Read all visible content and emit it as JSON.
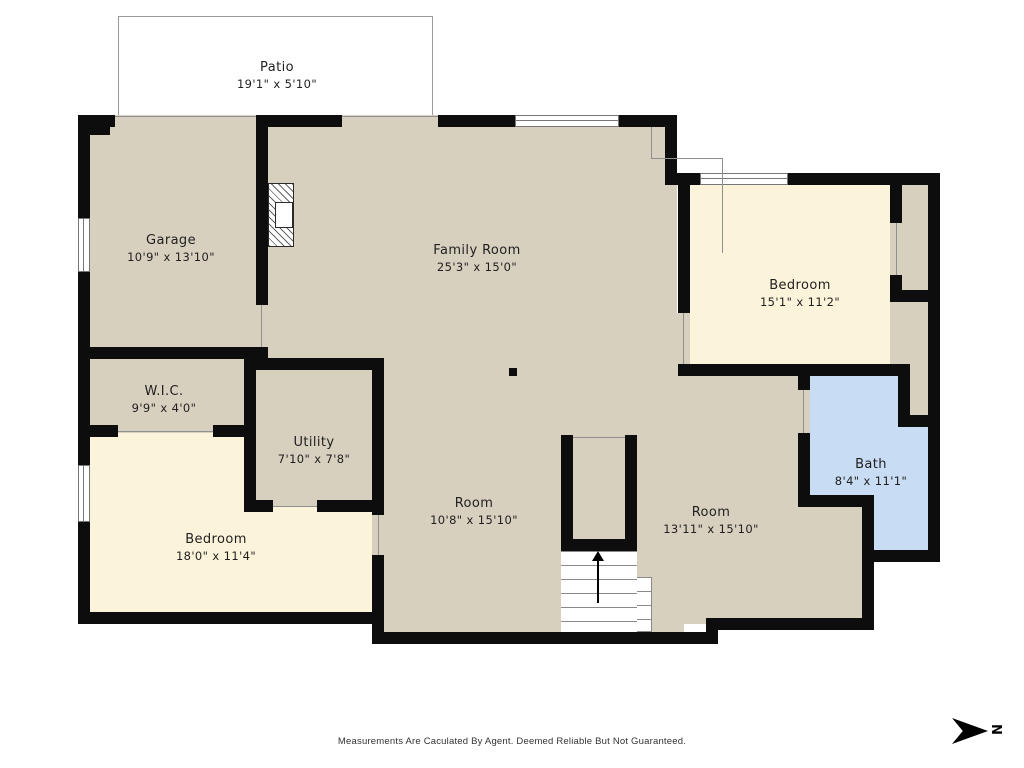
{
  "rooms": {
    "patio": {
      "name": "Patio",
      "dims": "19'1\" x 5'10\""
    },
    "garage": {
      "name": "Garage",
      "dims": "10'9\" x 13'10\""
    },
    "family_room": {
      "name": "Family Room",
      "dims": "25'3\" x 15'0\""
    },
    "bedroom_right": {
      "name": "Bedroom",
      "dims": "15'1\" x 11'2\""
    },
    "wic": {
      "name": "W.I.C.",
      "dims": "9'9\" x 4'0\""
    },
    "utility": {
      "name": "Utility",
      "dims": "7'10\" x 7'8\""
    },
    "bedroom_left": {
      "name": "Bedroom",
      "dims": "18'0\" x 11'4\""
    },
    "room_center": {
      "name": "Room",
      "dims": "10'8\" x 15'10\""
    },
    "room_right": {
      "name": "Room",
      "dims": "13'11\" x 15'10\""
    },
    "bath": {
      "name": "Bath",
      "dims": "8'4\" x 11'1\""
    }
  },
  "disclaimer": "Measurements Are Caculated By Agent. Deemed Reliable But Not Guaranteed.",
  "compass": {
    "letter": "N"
  },
  "colors": {
    "wall": "#0d0d0d",
    "room_tan": "#d8d0bf",
    "bedroom_cream": "#fcf4da",
    "bath_blue": "#c8dcf3"
  }
}
